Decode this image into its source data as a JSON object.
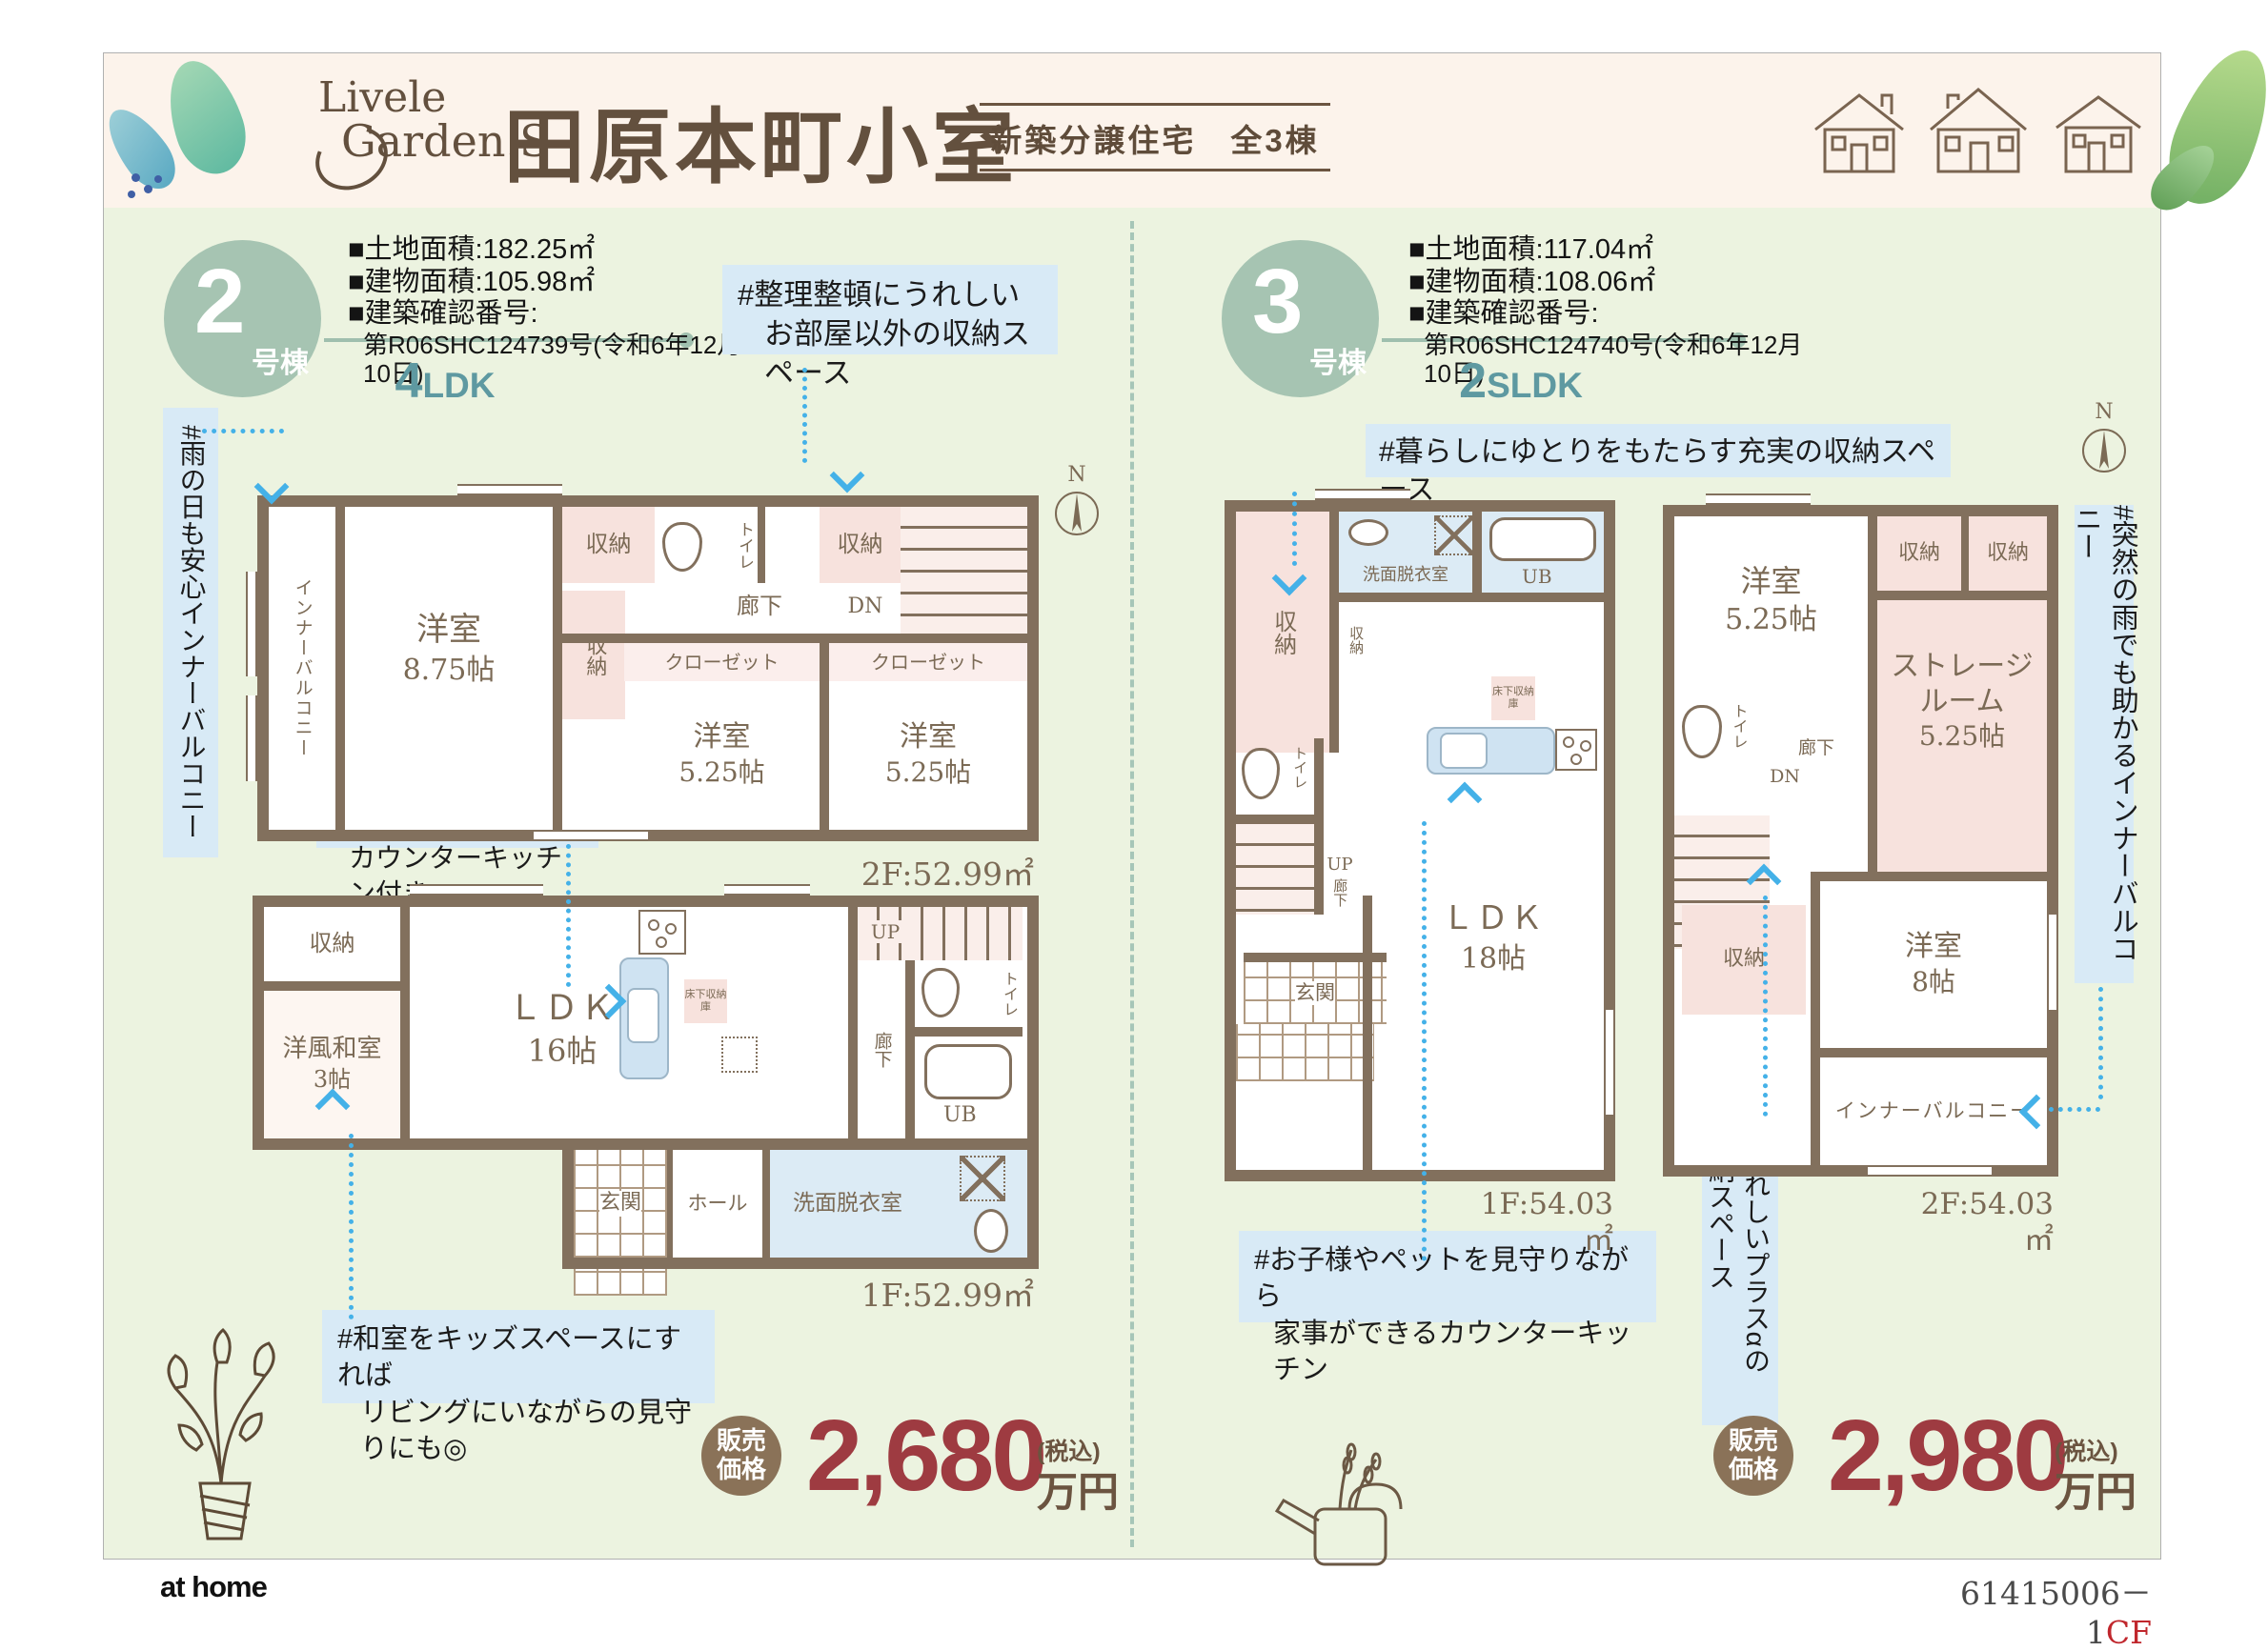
{
  "header": {
    "logo_top": "Livele",
    "logo_bottom": "Garden.S",
    "title": "田原本町小室",
    "subtitle": "新築分譲住宅　全3棟"
  },
  "footer": {
    "brand": "at home",
    "code": "61415006－1",
    "code_suffix": "CF"
  },
  "colors": {
    "brand_brown": "#6b5440",
    "wall_brown": "#82705d",
    "badge_green": "#a6c4b2",
    "type_teal": "#5e99a1",
    "tag_blue_bg": "#d8eaf6",
    "arrow_blue": "#44b1e8",
    "price_red": "#9e3b41",
    "panel_green": "#ecf3e0",
    "header_cream": "#fcf3eb"
  },
  "b2": {
    "badge_number": "2",
    "badge_suffix": "号棟",
    "spec1": "■土地面積:182.25㎡",
    "spec2": "■建物面積:105.98㎡",
    "spec3": "■建築確認番号:",
    "spec4": "第R06SHC124739号(令和6年12月10日)",
    "type_number": "4",
    "type_letters": "LDK",
    "tag_storage1": "#整理整頓にうれしい",
    "tag_storage2": "お部屋以外の収納スペース",
    "tag_balcony": "#雨の日も安心インナーバルコニー",
    "tag_kitchen1": "#みんなの会話がはずむ",
    "tag_kitchen2": "カウンターキッチン付き",
    "tag_kids1": "#和室をキッズスペースにすれば",
    "tag_kids2": "リビングにいながらの見守りにも◎",
    "f2": {
      "compass": "N",
      "area": "2F:52.99㎡",
      "balcony": "インナーバルコニー",
      "bed1": "洋室",
      "bed1_size": "8.75帖",
      "storage_top1": "収納",
      "toilet": "トイレ",
      "storage_top2": "収納",
      "hall": "廊下",
      "dn": "DN",
      "closet1": "クローゼット",
      "closet2": "クローゼット",
      "storage_mid": "収納",
      "bed2": "洋室",
      "bed2_size": "5.25帖",
      "bed3": "洋室",
      "bed3_size": "5.25帖"
    },
    "f1": {
      "area": "1F:52.99㎡",
      "storage": "収納",
      "washitsu": "洋風和室",
      "washitsu_size": "3帖",
      "ldk": "ＬＤＫ",
      "ldk_size": "16帖",
      "floor_storage": "床下収納庫",
      "up": "UP",
      "hall": "廊下",
      "toilet": "トイレ",
      "bath": "UB",
      "entrance": "玄関",
      "hall2": "ホール",
      "washroom": "洗面脱衣室"
    },
    "price": {
      "badge1": "販売",
      "badge2": "価格",
      "amount": "2,680",
      "tax": "(税込)",
      "unit": "万円"
    }
  },
  "b3": {
    "badge_number": "3",
    "badge_suffix": "号棟",
    "spec1": "■土地面積:117.04㎡",
    "spec2": "■建物面積:108.06㎡",
    "spec3": "■建築確認番号:",
    "spec4": "第R06SHC124740号(令和6年12月10日)",
    "type_number": "2",
    "type_letters": "SLDK",
    "tag_storage": "#暮らしにゆとりをもたらす充実の収納スペース",
    "tag_kitchen1": "#お子様やペットを見守りながら",
    "tag_kitchen2": "家事ができるカウンターキッチン",
    "tag_balcony": "#突然の雨でも助かるインナーバルコニー",
    "tag_plus1": "#うれしいプラスαの",
    "tag_plus2": "収納スペース",
    "f1": {
      "area": "1F:54.03㎡",
      "storage_big": "収納",
      "washroom": "洗面脱衣室",
      "bath": "UB",
      "storage_small": "収納",
      "floor_storage": "床下収納庫",
      "toilet": "トイレ",
      "up": "UP",
      "hall": "廊下",
      "entrance": "玄関",
      "ldk": "ＬＤＫ",
      "ldk_size": "18帖"
    },
    "f2": {
      "compass": "N",
      "area": "2F:54.03㎡",
      "bed1": "洋室",
      "bed1_size": "5.25帖",
      "storage1": "収納",
      "storage2": "収納",
      "sr1": "ストレージ",
      "sr2": "ルーム",
      "sr3": "5.25帖",
      "toilet": "トイレ",
      "hall": "廊下",
      "dn": "DN",
      "storage3": "収納",
      "bed2": "洋室",
      "bed2_size": "8帖",
      "balcony": "インナーバルコニー"
    },
    "price": {
      "badge1": "販売",
      "badge2": "価格",
      "amount": "2,980",
      "tax": "(税込)",
      "unit": "万円"
    }
  }
}
